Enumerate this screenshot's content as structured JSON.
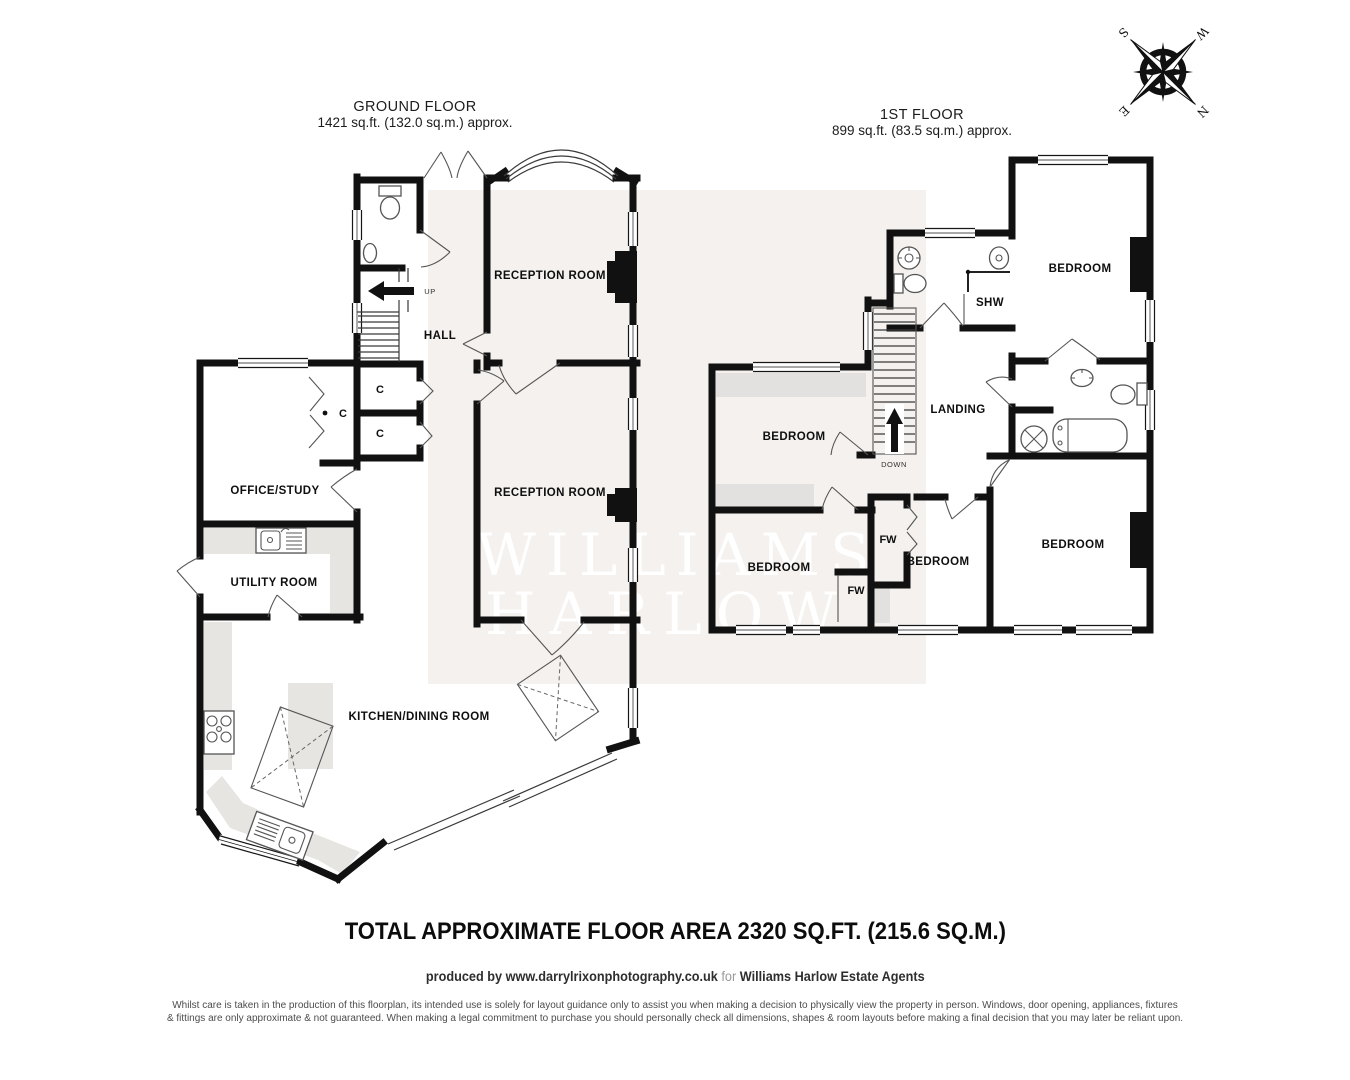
{
  "ground_floor": {
    "title": "GROUND FLOOR",
    "area": "1421 sq.ft. (132.0 sq.m.) approx.",
    "labels": {
      "reception_1": "RECEPTION ROOM",
      "reception_2": "RECEPTION ROOM",
      "hall": "HALL",
      "office": "OFFICE/STUDY",
      "utility": "UTILITY ROOM",
      "kitchen": "KITCHEN/DINING ROOM",
      "cupboard_1": "C",
      "cupboard_2": "C",
      "cupboard_3": "C",
      "up": "UP"
    }
  },
  "first_floor": {
    "title": "1ST FLOOR",
    "area": "899 sq.ft. (83.5 sq.m.) approx.",
    "labels": {
      "bedroom_top_right": "BEDROOM",
      "bedroom_mid_left": "BEDROOM",
      "bedroom_bottom_left": "BEDROOM",
      "bedroom_middle": "BEDROOM",
      "bedroom_bottom_right": "BEDROOM",
      "landing": "LANDING",
      "shower": "SHW",
      "wardrobe_1": "FW",
      "wardrobe_2": "FW",
      "down": "DOWN"
    }
  },
  "compass": {
    "north": "N",
    "east": "E",
    "south": "S",
    "west": "W"
  },
  "watermark": {
    "line1": "WILLIAMS",
    "line2": "HARLOW"
  },
  "footer": {
    "total": "TOTAL APPROXIMATE FLOOR AREA 2320 SQ.FT. (215.6 SQ.M.)",
    "credit_prefix": "produced by",
    "credit_url": "www.darrylrixonphotography.co.uk",
    "credit_mid": "for",
    "credit_agent": "Williams Harlow Estate Agents",
    "disclaimer_line1": "Whilst care is taken in the production of this floorplan, its intended use is solely for layout guidance only to assist you  when making a decision to physically view the property in person. Windows, door opening, appliances, fixtures",
    "disclaimer_line2": "& fittings are only approximate & not guaranteed. When making a legal commitment to purchase you should personally check all dimensions, shapes & room layouts before making a final decision that you may later be reliant upon."
  },
  "colors": {
    "wall": "#111111",
    "watermark_panel": "#f4f1ee",
    "watermark_text": "#ffffff",
    "counter_grey": "#e7e5e2",
    "eaves_grey": "#e2e1df"
  }
}
